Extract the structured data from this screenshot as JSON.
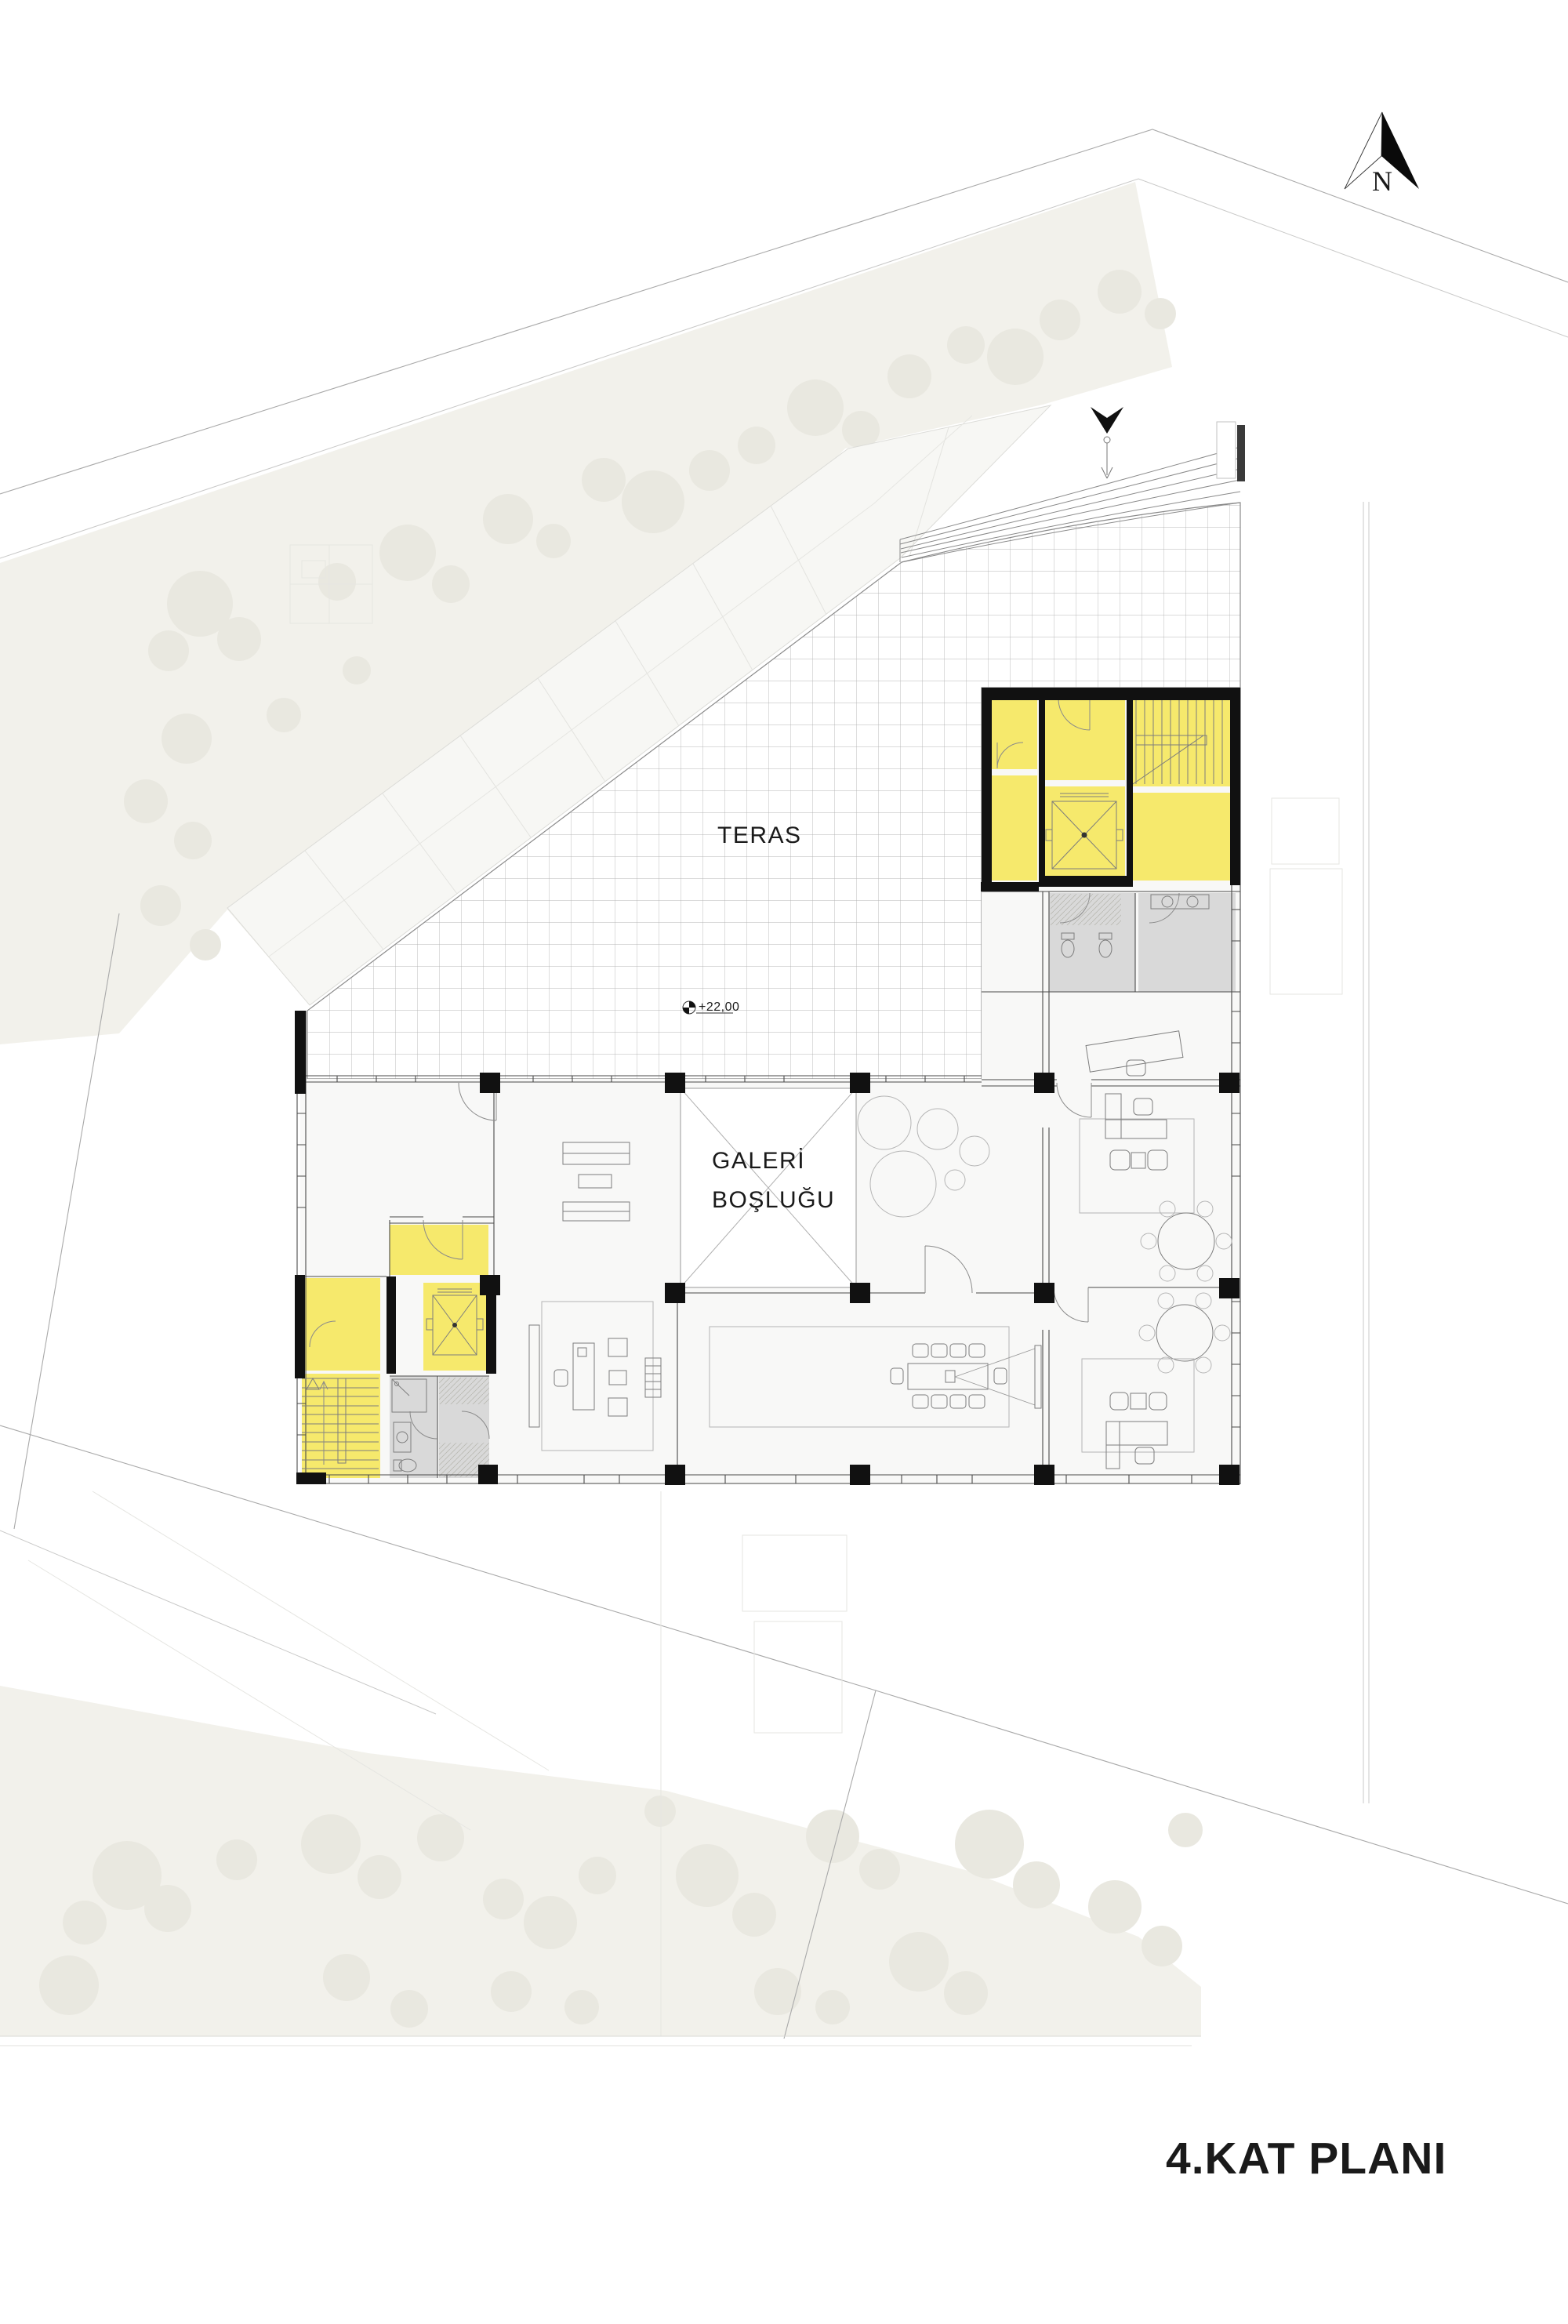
{
  "title": {
    "text": "4.KAT PLANI"
  },
  "north_arrow": {
    "label": "N"
  },
  "labels": {
    "terrace": "TERAS",
    "gallery_void_line1": "GALERİ",
    "gallery_void_line2": "BOŞLUĞU",
    "level_marker": "+22,00"
  },
  "legend_colors": {
    "circulation_core": "#F6E96C",
    "wet_areas": "#D9D9D9",
    "walls": "#111111",
    "terrace_grid_line": "#B5B5B5",
    "context_ground": "#F2F1EB",
    "context_tree": "#E9E8E0",
    "floor": "#F8F8F7",
    "text": "#1A1A1A"
  }
}
